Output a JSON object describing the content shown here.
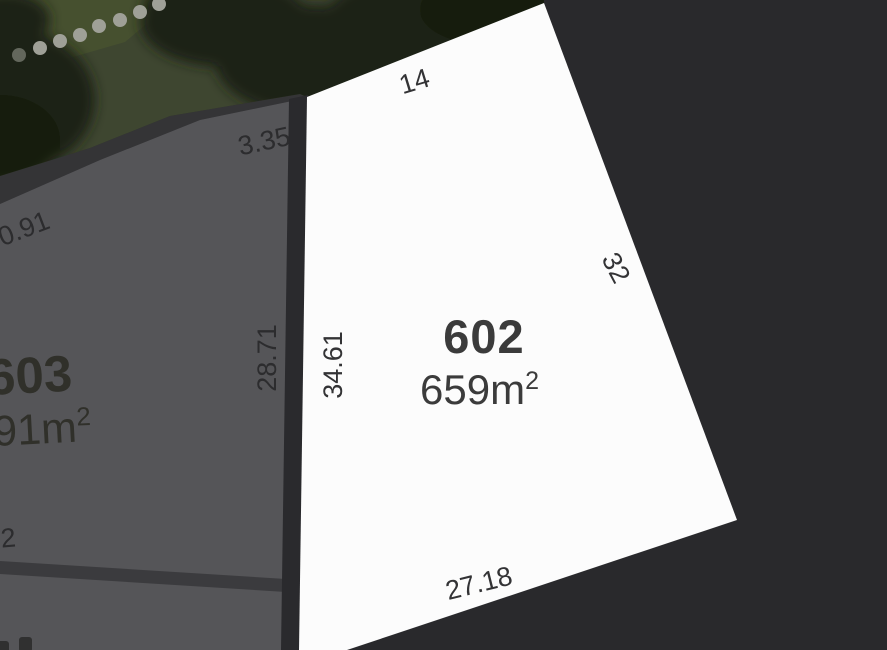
{
  "map": {
    "type": "land-lot-plan",
    "lot_602": {
      "number": "602",
      "area_value": "659m",
      "area_exponent": "2",
      "dim_top": "14",
      "dim_right": "32",
      "dim_bottom": "27.18",
      "dim_left": "34.61"
    },
    "lot_603": {
      "number": "603",
      "area_value_visible": "91m",
      "area_exponent": "2",
      "dim_right": "28.71",
      "dim_top": "3.35",
      "dim_upper_left": "0.91",
      "dim_bottom_fragment": "2"
    },
    "colors": {
      "background": "#29292C",
      "lot_602_fill": "#FCFCFC",
      "lot_603_fill": "#555558",
      "boundary_strip": "#2A2A2D",
      "inner_boundary": "#3B3B3E",
      "vegetation": "#3E4630",
      "tree_canopy": "#1B2212",
      "footpath_dots": "#9FA097",
      "dimension_text": "#333335",
      "lot_number_text": "#3B3B3B"
    }
  }
}
